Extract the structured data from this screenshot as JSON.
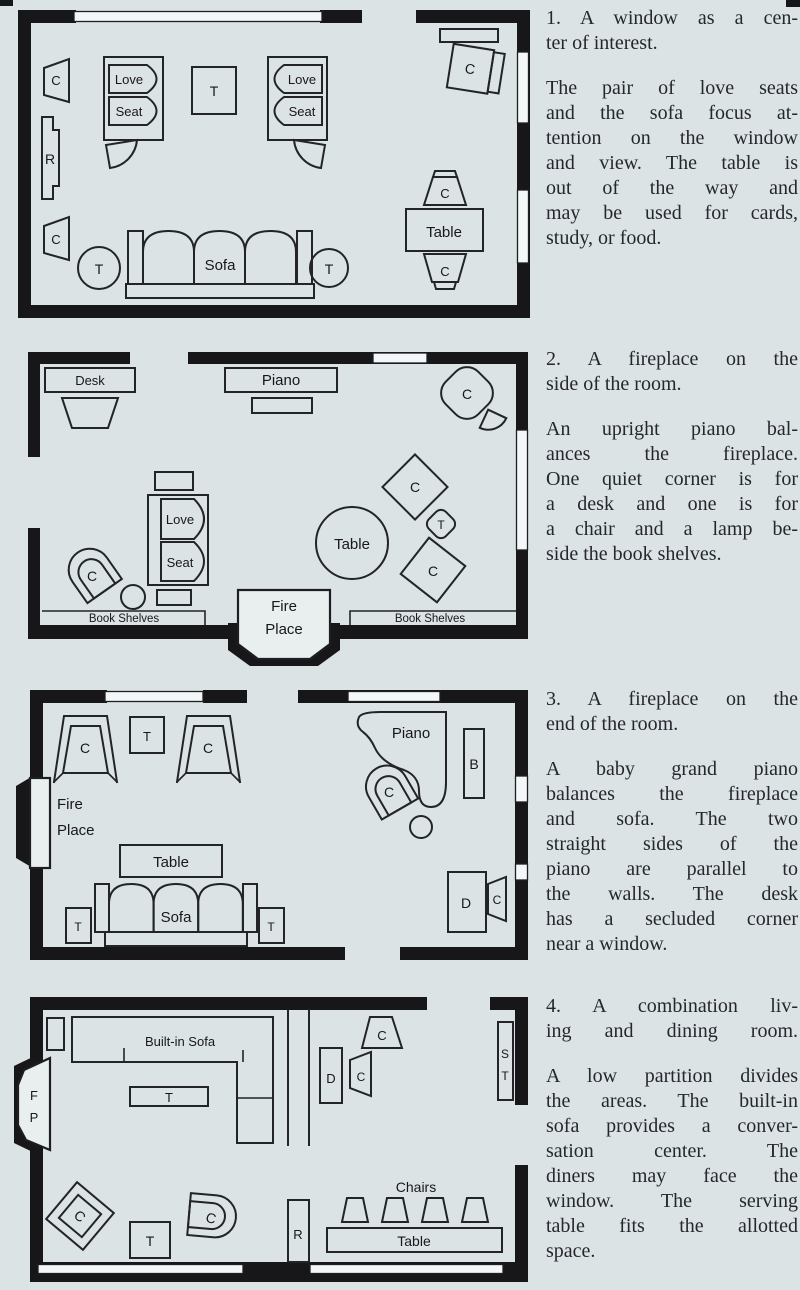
{
  "page": {
    "background": "#dbe3e5",
    "ink": "#17171a",
    "window_fill": "#f3f7f7",
    "fireplace_fill": "#e9efef"
  },
  "plan_labels": {
    "chair": "C",
    "table_abbr": "T",
    "radio": "R",
    "love": "Love",
    "seat": "Seat",
    "sofa": "Sofa",
    "table": "Table",
    "desk_word": "Desk",
    "piano": "Piano",
    "fire": "Fire",
    "place": "Place",
    "book_shelves": "Book Shelves",
    "bookcase_abbr": "B",
    "desk_abbr": "D",
    "built_in_sofa": "Built-in Sofa",
    "fireplace_f": "F",
    "fireplace_p": "P",
    "serving_s": "S",
    "serving_t": "T",
    "chairs": "Chairs"
  },
  "sections": [
    {
      "heading_lines": [
        "1. A window as a cen-",
        "ter of interest."
      ],
      "body_lines": [
        "The pair of love seats",
        "and the sofa focus at-",
        "tention on the window",
        "and view. The table is",
        "out of the way and",
        "may be used for cards,",
        "study, or food."
      ]
    },
    {
      "heading_lines": [
        "2. A fireplace on the",
        "side of the room."
      ],
      "body_lines": [
        "An upright piano bal-",
        "ances the fireplace.",
        "One quiet corner is for",
        "a desk and one is for",
        "a chair and a lamp be-",
        "side the book shelves."
      ]
    },
    {
      "heading_lines": [
        "3. A fireplace on the",
        "end of the room."
      ],
      "body_lines": [
        "A baby grand piano",
        "balances the fireplace",
        "and sofa. The two",
        "straight sides of the",
        "piano are parallel to",
        "the walls. The desk",
        "has a secluded corner",
        "near a window."
      ]
    },
    {
      "heading_lines": [
        "4. A combination liv-",
        "ing and dining room."
      ],
      "body_lines": [
        "A low partition divides",
        "the areas. The built-in",
        "sofa provides a conver-",
        "sation center. The",
        "diners may face the",
        "window. The serving",
        "table fits the allotted",
        "space."
      ]
    }
  ]
}
